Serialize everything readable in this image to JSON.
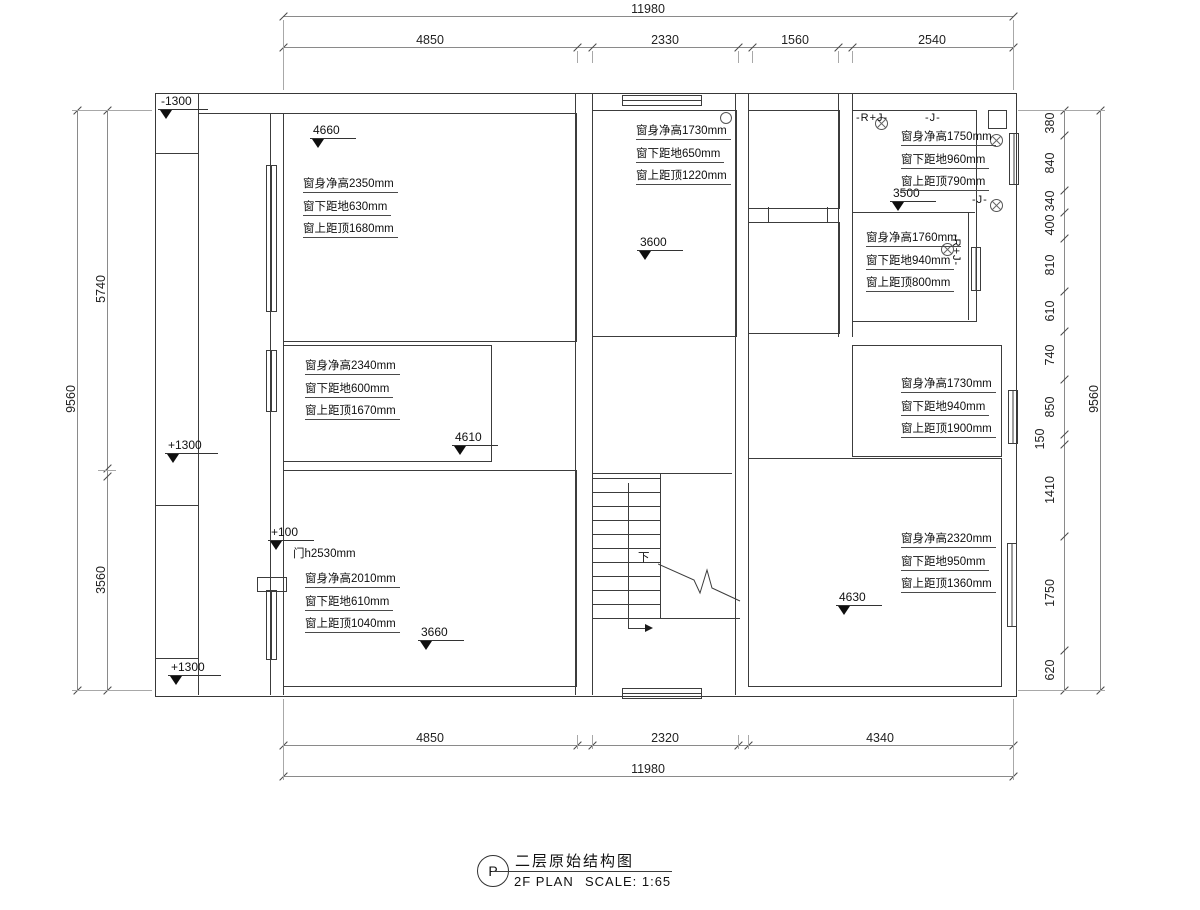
{
  "title_block": {
    "bubble": "P",
    "title_cn": "二层原始结构图",
    "plan_label": "2F PLAN",
    "scale_label": "SCALE: 1:65"
  },
  "dims": {
    "top": {
      "overall": "11980",
      "segments": [
        "4850",
        "2330",
        "1560",
        "2540"
      ]
    },
    "bottom": {
      "overall": "11980",
      "segments": [
        "4850",
        "2320",
        "4340"
      ]
    },
    "left": {
      "overall": "9560",
      "segments": [
        "5740",
        "3560"
      ]
    },
    "right": {
      "overall": "9560",
      "segments": [
        "380",
        "840",
        "340",
        "400",
        "810",
        "610",
        "740",
        "850",
        "150",
        "1410",
        "1750",
        "620"
      ]
    }
  },
  "levels": {
    "neg1300": "-1300",
    "pos1300_mid": "+1300",
    "pos1300_bot": "+1300",
    "pos100": "+100",
    "lv4660": "4660",
    "lv3600": "3600",
    "lv3500": "3500",
    "lv4610": "4610",
    "lv3660": "3660",
    "lv4630": "4630"
  },
  "annotations": {
    "top_left": [
      "窗身净高2350mm",
      "窗下距地630mm",
      "窗上距顶1680mm"
    ],
    "top_mid": [
      "窗身净高1730mm",
      "窗下距地650mm",
      "窗上距顶1220mm"
    ],
    "top_right": [
      "窗身净高1750mm",
      "窗下距地960mm",
      "窗上距顶790mm"
    ],
    "right_upper": [
      "窗身净高1760mm",
      "窗下距地940mm",
      "窗上距顶800mm"
    ],
    "right_mid": [
      "窗身净高1730mm",
      "窗下距地940mm",
      "窗上距顶1900mm"
    ],
    "right_bottom": [
      "窗身净高2320mm",
      "窗下距地950mm",
      "窗上距顶1360mm"
    ],
    "left_mid": [
      "窗身净高2340mm",
      "窗下距地600mm",
      "窗上距顶1670mm"
    ],
    "left_bottom": [
      "窗身净高2010mm",
      "窗下距地610mm",
      "窗上距顶1040mm"
    ]
  },
  "door_label": "门h2530mm",
  "tags": {
    "rj_top": "-R+J-",
    "j_top": "-J-",
    "j_mid": "-J-",
    "rj_vert": "-R+J-"
  },
  "stairs": {
    "down": "下"
  },
  "colors": {
    "line": "#3c3c3c",
    "dim": "#8a8a8a",
    "text": "#111111"
  }
}
